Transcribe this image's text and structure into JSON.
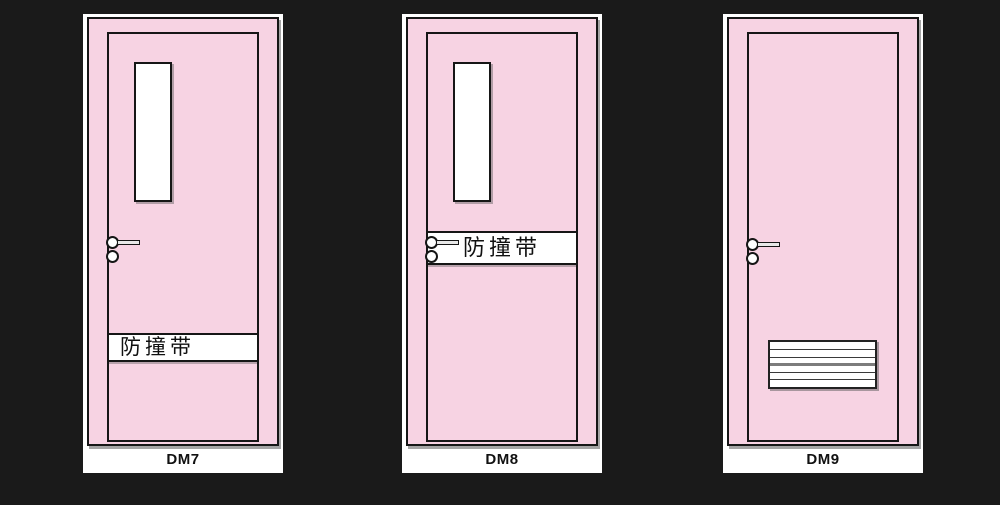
{
  "colors": {
    "background": "#1a1a1a",
    "door_pink": "#f7d3e3",
    "panel_white": "#ffffff",
    "outline": "#161616"
  },
  "doors": [
    {
      "label": "DM7",
      "features": {
        "window": true,
        "handle": true,
        "bumper_band": {
          "text": "防撞带",
          "position": "lower",
          "align": "left"
        },
        "vent": false
      }
    },
    {
      "label": "DM8",
      "features": {
        "window": true,
        "handle": true,
        "bumper_band": {
          "text": "防撞带",
          "position": "middle",
          "align": "center"
        },
        "vent": false
      }
    },
    {
      "label": "DM9",
      "features": {
        "window": false,
        "handle": true,
        "bumper_band": null,
        "vent": {
          "slats": 6
        }
      }
    }
  ]
}
